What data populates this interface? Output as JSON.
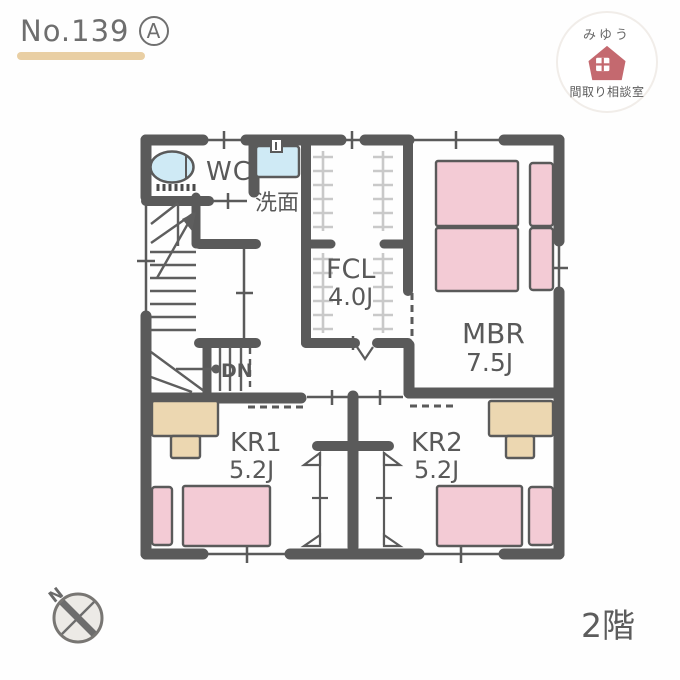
{
  "title": {
    "number": "No.139",
    "variant": "A"
  },
  "logo": {
    "name": "みゆう",
    "subtitle": "間取り相談室"
  },
  "floor": {
    "label": "2階"
  },
  "compass": {
    "north": "N"
  },
  "rooms": {
    "wc": {
      "label": "WC"
    },
    "washroom": {
      "label": "洗面"
    },
    "fcl": {
      "label": "FCL",
      "size": "4.0J"
    },
    "mbr": {
      "label": "MBR",
      "size": "7.5J"
    },
    "kr1": {
      "label": "KR1",
      "size": "5.2J"
    },
    "kr2": {
      "label": "KR2",
      "size": "5.2J"
    },
    "stairs": {
      "down_label": "DN"
    }
  },
  "colors": {
    "wall": "#5a5a5a",
    "bed_pink": "#f3cbd5",
    "desk_tan": "#ecd7b1",
    "fixture_blue": "#cfeaf5",
    "hanger_gray": "#c9c9c9",
    "logo_rose": "#c4696f",
    "underline_tan": "#e9cfa4"
  }
}
